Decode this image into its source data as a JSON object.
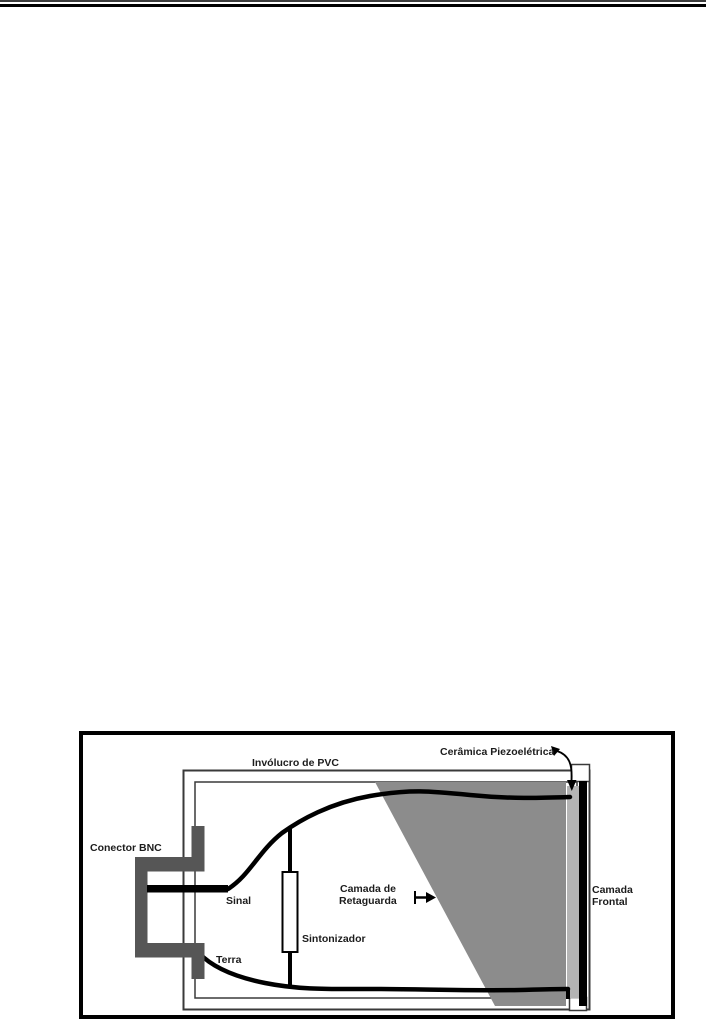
{
  "figure": {
    "labels": {
      "housing": "Invólucro de PVC",
      "ceramic": "Cerâmica Piezoelétrica",
      "connector": "Conector BNC",
      "signal": "Sinal",
      "ground": "Terra",
      "tuner": "Sintonizador",
      "backing_line1": "Camada de",
      "backing_line2": "Retaguarda",
      "front_line1": "Camada",
      "front_line2": "Frontal"
    },
    "colors": {
      "connector_gray": "#565656",
      "backing_gray": "#8c8c8c",
      "piezo_gray": "#b4b4b4",
      "outline_gray": "#3a3a3a",
      "line_black": "#000000"
    }
  }
}
